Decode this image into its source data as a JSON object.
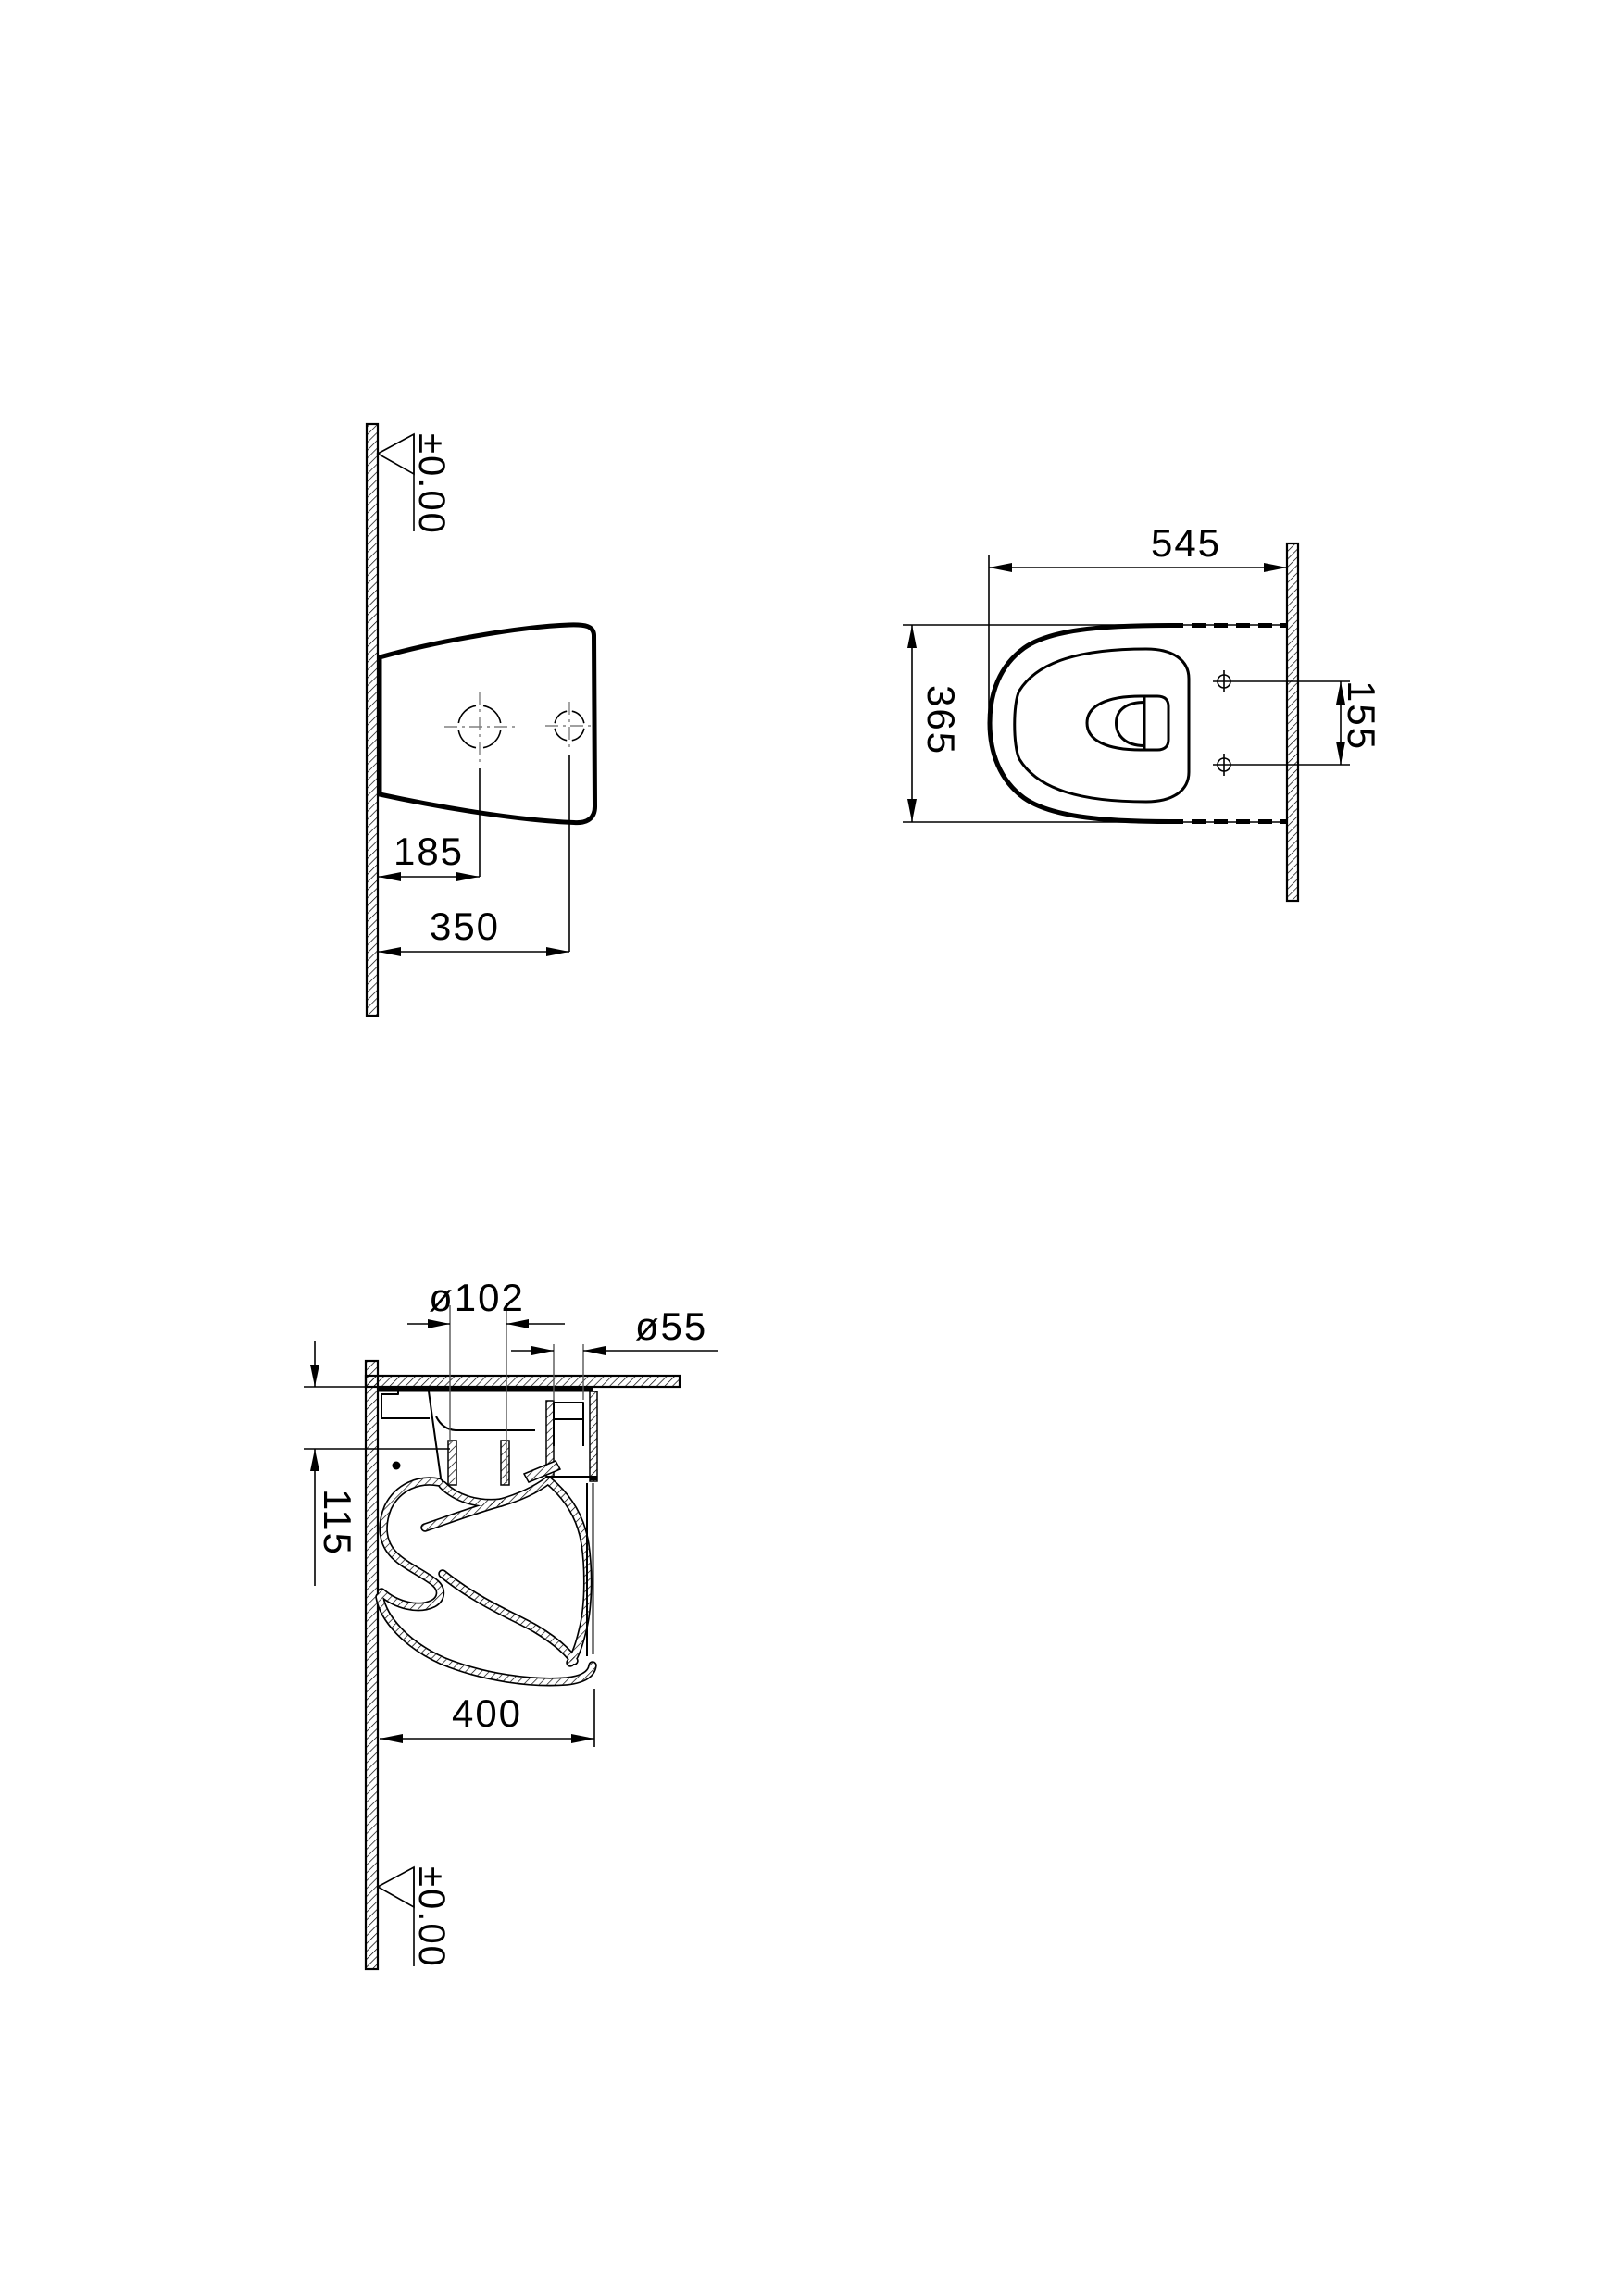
{
  "drawing": {
    "background": "#ffffff",
    "line_color": "#000000",
    "centerline_color": "#808080",
    "views": {
      "side_elevation": {
        "level": "±0.00",
        "dims": {
          "hole1_from_wall": "185",
          "hole2_from_wall": "350"
        }
      },
      "plan": {
        "dims": {
          "length": "545",
          "width": "365",
          "hole_spacing": "155"
        }
      },
      "section": {
        "level": "±0.00",
        "dims": {
          "outlet_diameter": "ø102",
          "inlet_diameter": "ø55",
          "offset": "115",
          "depth": "400"
        }
      }
    }
  }
}
